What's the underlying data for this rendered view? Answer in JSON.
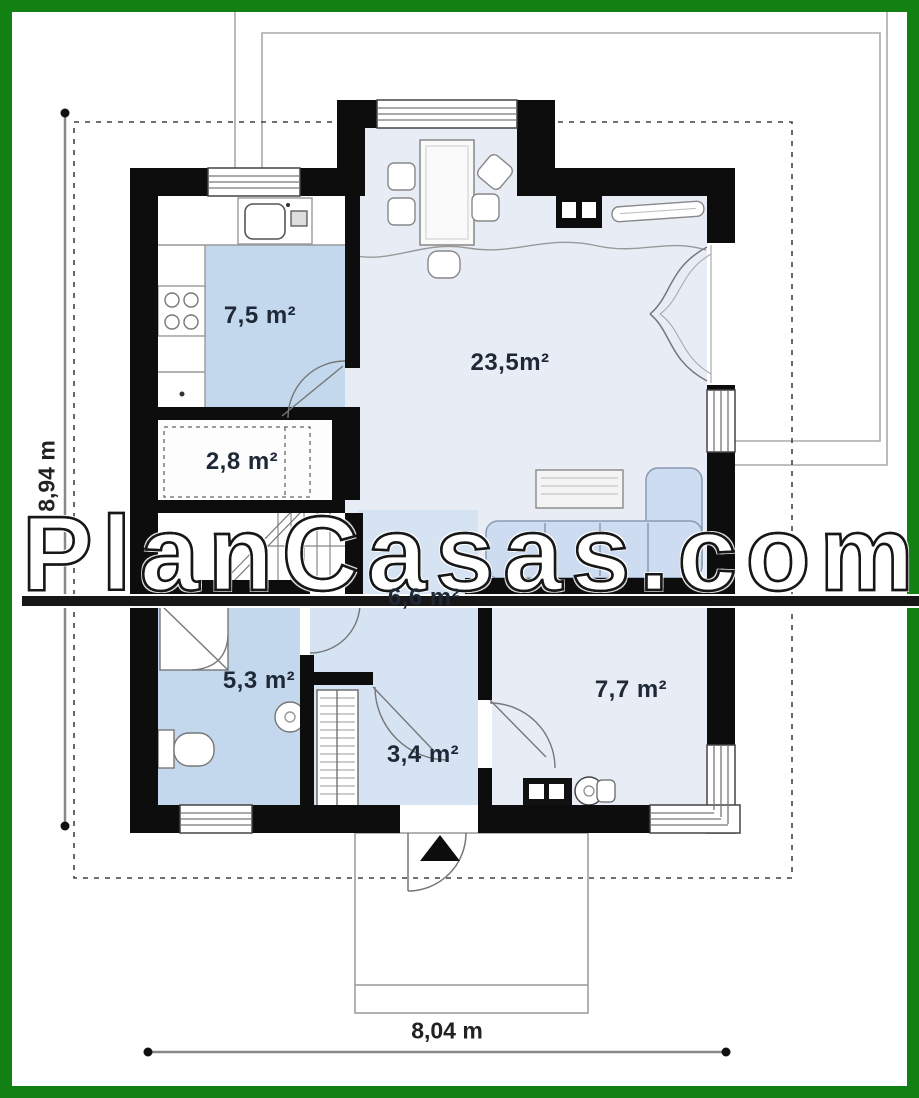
{
  "watermark": {
    "text": "PlanCasas.com"
  },
  "dimensions": {
    "vertical": "8,94 m",
    "horizontal": "8,04 m"
  },
  "rooms": {
    "kitchen": {
      "area": "7,5 m²"
    },
    "living_dining": {
      "area": "23,5m²"
    },
    "pantry": {
      "area": "2,8 m²"
    },
    "hall": {
      "area": "6,6 m²"
    },
    "bathroom": {
      "area": "5,3 m²"
    },
    "entry": {
      "area": "3,4 m²"
    },
    "bedroom": {
      "area": "7,7 m²"
    }
  },
  "colors": {
    "frame_green": "#128012",
    "wall_black": "#0d0d0d",
    "room_blue": "#c3d8ed",
    "hall_blue": "#d6e3f3",
    "living_blue": "#e8edf5",
    "sofa_blue": "#cddcf0",
    "label_navy": "#1e2836",
    "line_gray": "#999999"
  }
}
